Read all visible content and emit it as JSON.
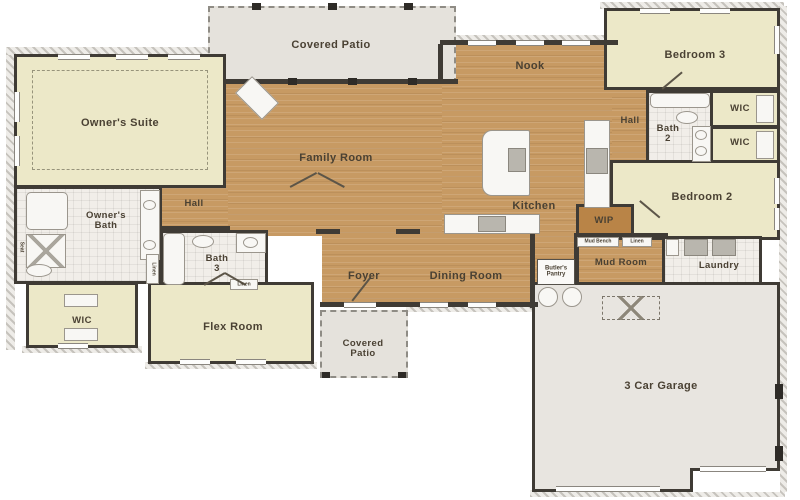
{
  "colors": {
    "wall": "#3f3b35",
    "wood_floor": "#c79a63",
    "carpet": "#ece8c8",
    "tile": "#f1eee9",
    "patio_concrete": "#e5e2dc",
    "garage_floor": "#e8e5e0",
    "label_text": "#4a4133",
    "wip_fill": "#b98447"
  },
  "labels": {
    "covered_patio": "Covered Patio",
    "covered_patio_l1": "Covered",
    "covered_patio_l2": "Patio",
    "owners_suite": "Owner's Suite",
    "family_room": "Family Room",
    "nook": "Nook",
    "bedroom3": "Bedroom 3",
    "bedroom2": "Bedroom 2",
    "hall": "Hall",
    "bath2_l1": "Bath",
    "bath2_l2": "2",
    "bath3_l1": "Bath",
    "bath3_l2": "3",
    "wic": "WIC",
    "kitchen": "Kitchen",
    "wip": "WIP",
    "owners_bath_l1": "Owner's",
    "owners_bath_l2": "Bath",
    "flex_room": "Flex Room",
    "foyer": "Foyer",
    "dining_room": "Dining Room",
    "mud_room": "Mud Room",
    "laundry": "Laundry",
    "garage": "3 Car Garage",
    "butlers_pantry_l1": "Butler's",
    "butlers_pantry_l2": "Pantry",
    "mud_bench": "Mud Bench",
    "linen": "Linen",
    "seat": "Seat"
  }
}
